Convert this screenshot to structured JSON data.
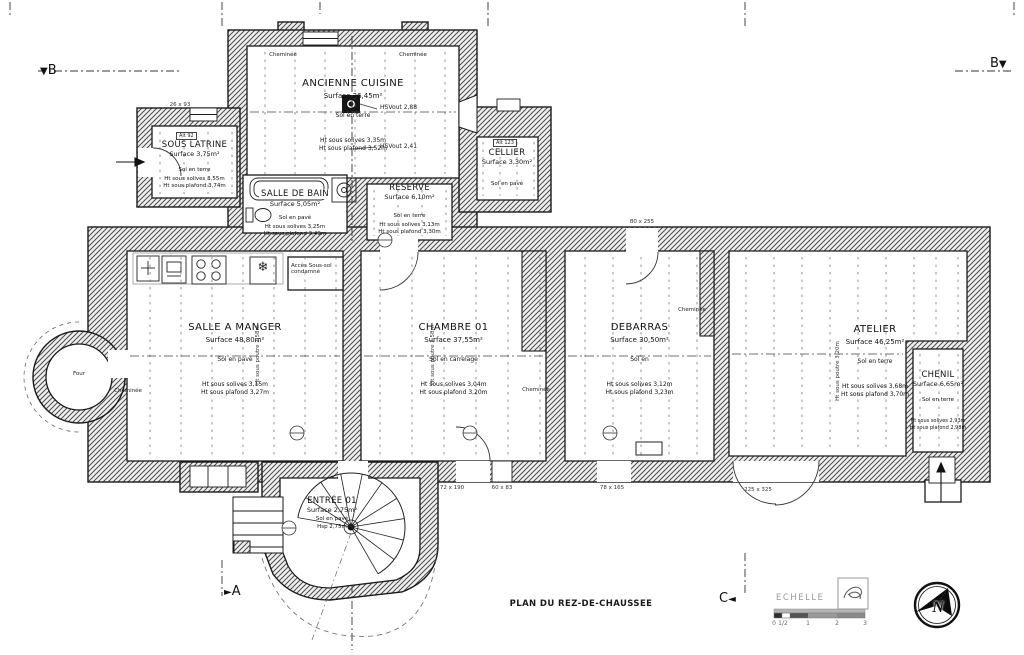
{
  "page": {
    "title": "PLAN DU REZ-DE-CHAUSSEE",
    "scale_label": "ECHELLE",
    "scale_ticks": [
      "0",
      "1/2",
      "1",
      "2",
      "3"
    ],
    "compass_n": "N",
    "markers": {
      "b_left": "B",
      "b_right": "B",
      "a": "A",
      "c": "C",
      "tri_down": "▼",
      "tri_right": "►",
      "tri_left": "◄"
    }
  },
  "rooms": {
    "ancienne_cuisine": {
      "name": "ANCIENNE CUISINE",
      "surface": "Surface 26,45m²",
      "floor": "Sol en terre",
      "h1": "Ht sous solives 3,35m",
      "h2": "Ht sous plafond 3,52m"
    },
    "sous_latrine": {
      "name": "SOUS LATRINE",
      "surface": "Surface 3,75m²",
      "floor": "Sol en terre",
      "h1": "Ht sous solives 3,55m",
      "h2": "Ht sous plafond 3,74m"
    },
    "cellier": {
      "name": "CELLIER",
      "surface": "Surface 3,30m²",
      "floor": "Sol en pavé"
    },
    "salle_de_bain": {
      "name": "SALLE DE BAIN",
      "surface": "Surface 5,05m²",
      "floor": "Sol en pavé",
      "h1": "Ht sous solives 3,25m",
      "h2": "Ht sous plafond 3,49m"
    },
    "reserve": {
      "name": "RÉSERVE",
      "surface": "Surface 6,10m²",
      "floor": "Sol en terre",
      "h1": "Ht sous solives 3,13m",
      "h2": "Ht sous plafond 3,30m"
    },
    "salle_a_manger": {
      "name": "SALLE A MANGER",
      "surface": "Surface 48,80m²",
      "floor": "Sol en pavé",
      "h1": "Ht sous solives 3,15m",
      "h2": "Ht sous plafond 3,27m",
      "beam": "Ht sous poutre 2,58m"
    },
    "chambre_01": {
      "name": "CHAMBRE 01",
      "surface": "Surface 37,55m²",
      "floor": "Sol en carrelage",
      "h1": "Ht sous solives 3,04m",
      "h2": "Ht sous plafond 3,20m",
      "beam": "Ht sous poutre 2,58m"
    },
    "debarras": {
      "name": "DEBARRAS",
      "surface": "Surface 30,50m²",
      "floor": "Sol en",
      "h1": "Ht sous solives 3,12m",
      "h2": "Ht sous plafond 3,23m"
    },
    "atelier": {
      "name": "ATELIER",
      "surface": "Surface 46,25m²",
      "floor": "Sol en terre",
      "h1": "Ht sous solives 3,68m",
      "h2": "Ht sous plafond 3,70m",
      "beam": "Ht sous poutre 3,20m"
    },
    "chenil": {
      "name": "CHENIL",
      "surface": "Surface 6,65m²",
      "floor": "Sol en terre",
      "h1": "Ht sous solives 2,93m",
      "h2": "Ht sous plafond 2,98m"
    },
    "entree_01": {
      "name": "ENTRÉE 01",
      "surface": "Surface 2,75m²",
      "floor": "Sol en pavé",
      "h1": "Hsp 2,75m"
    }
  },
  "annotations": {
    "acces_line1": "Accès Sous-sol",
    "acces_line2": "condamné",
    "four": "Four",
    "cheminee": "Cheminée",
    "hsv_top": "HSVout 2,88",
    "hsv_bottom": "HSVout 2,41",
    "alt_sous_latrine": "Alt 92",
    "alt_cellier": "Alt 123",
    "dim_window_nw": "26 x 93",
    "dim_door_debarras": "80 x 255",
    "dim_door_chambre": "72 x 190",
    "dim_window_chambre": "60 x 83",
    "dim_door_debarras_s": "78 x 165",
    "dim_door_atelier": "225 x 325"
  },
  "icons": {
    "freezer": "❄"
  }
}
